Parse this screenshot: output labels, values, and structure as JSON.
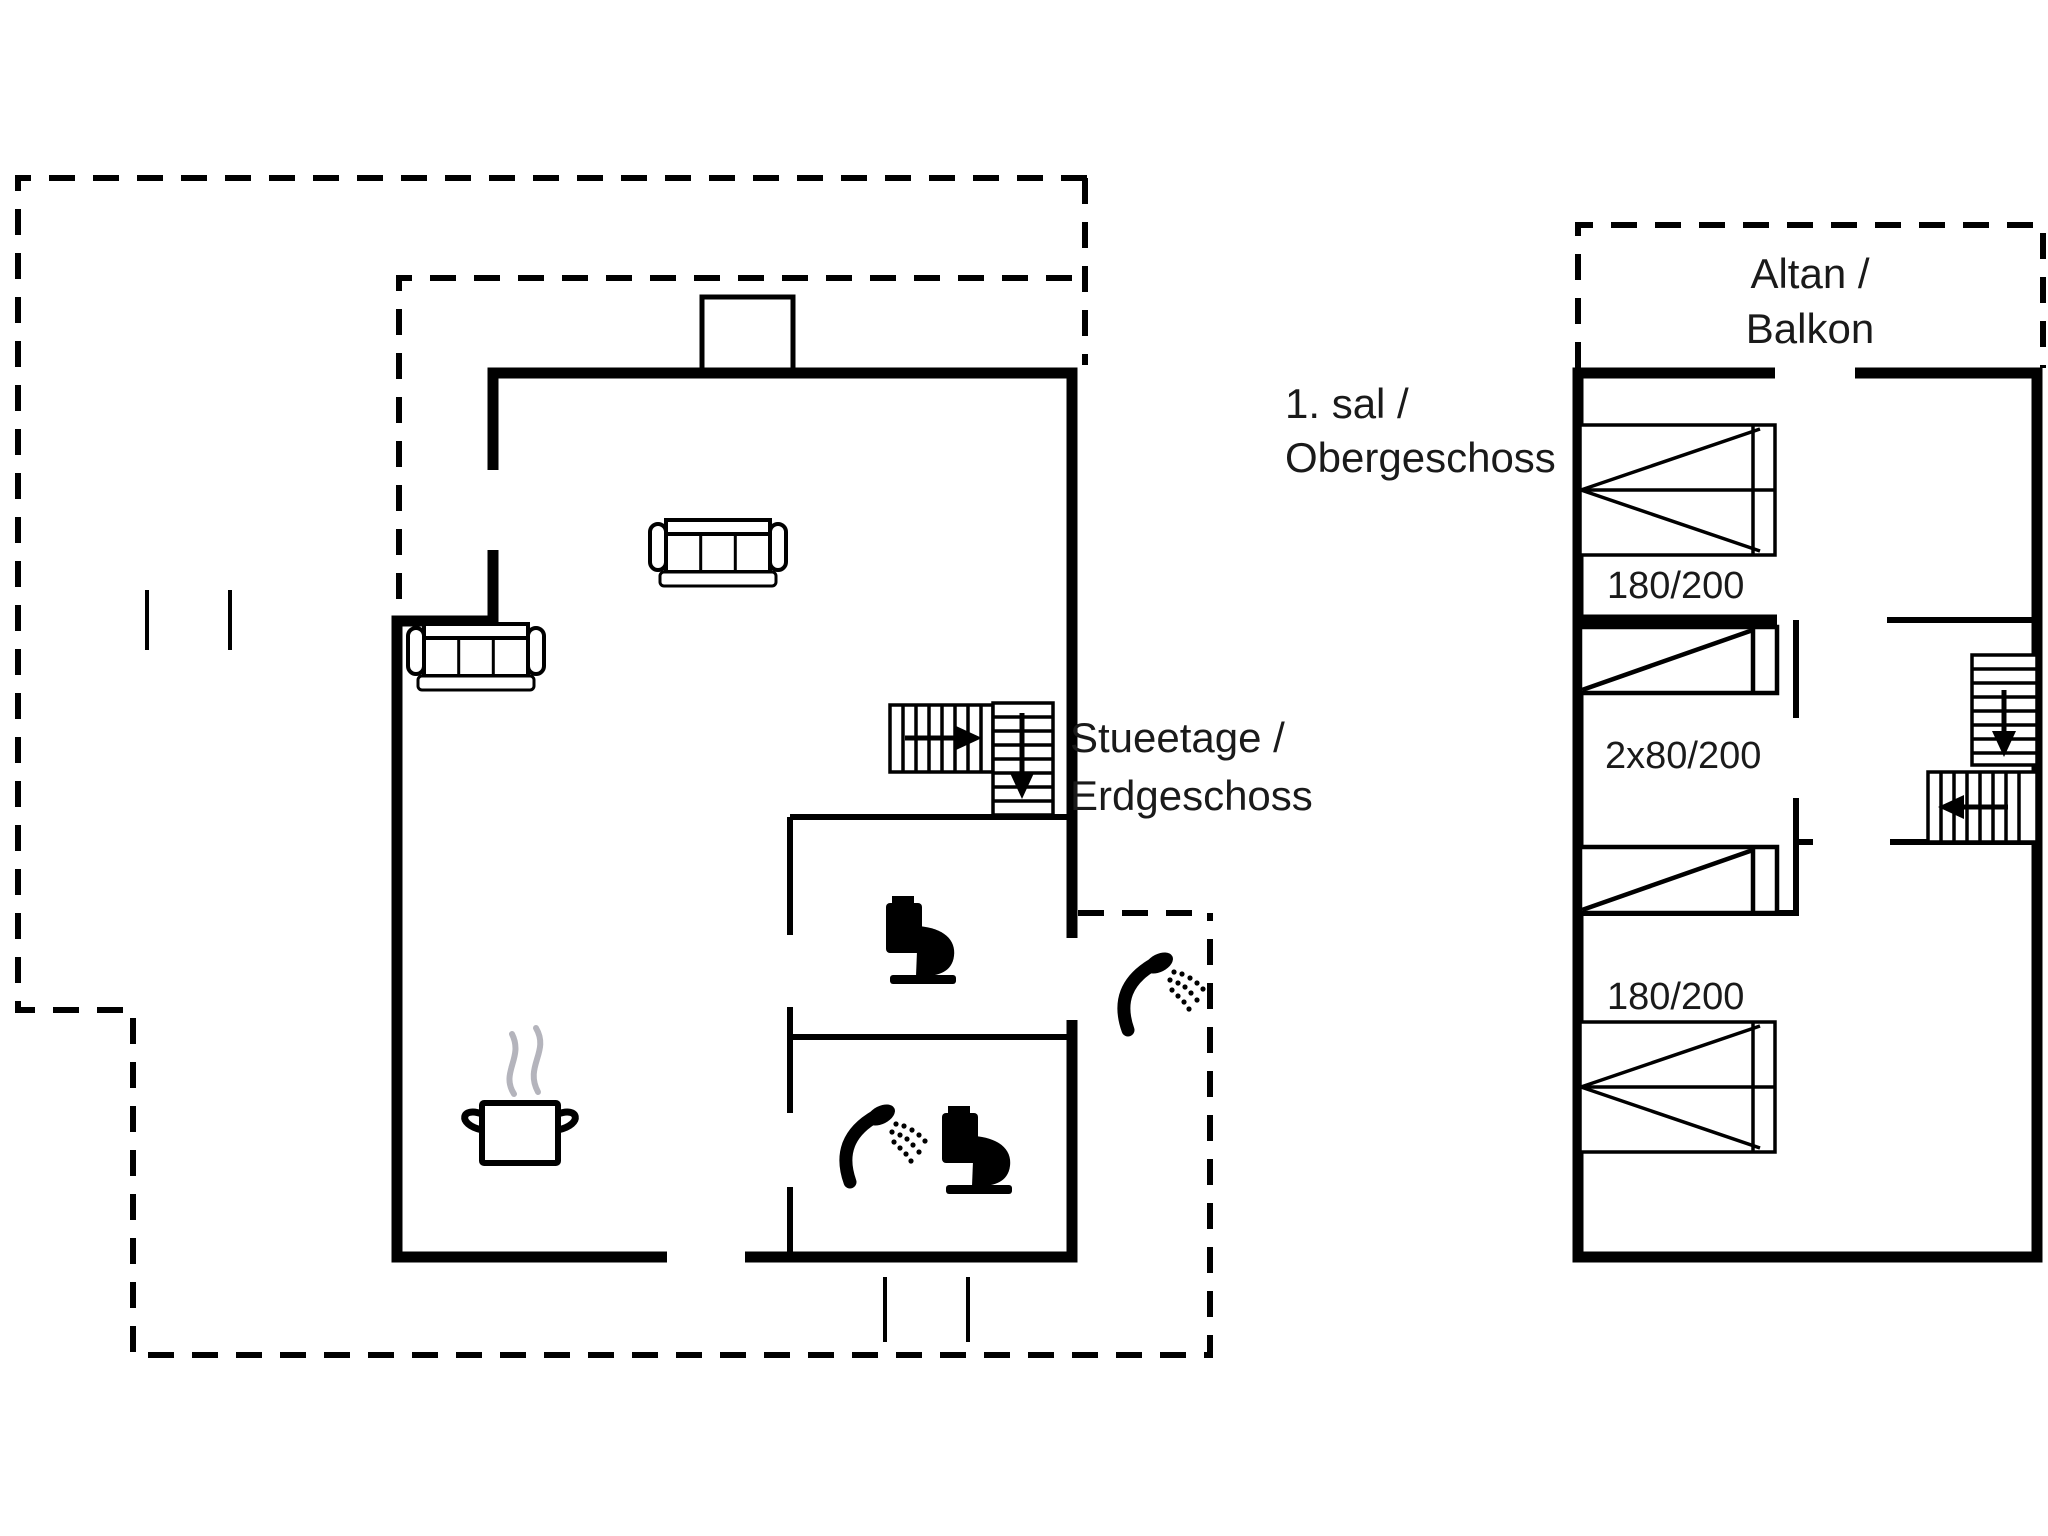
{
  "document": {
    "type": "house floor plan",
    "background_color": "#ffffff",
    "line_color": "#000000",
    "text_color": "#1a1a1a",
    "steam_color": "#b4b4bc"
  },
  "ground_floor": {
    "name_line1": "Stueetage /",
    "name_line2": "Erdgeschoss",
    "icons": [
      "sofa-icon",
      "sofa-icon",
      "cooking-pot-icon",
      "steam-icon",
      "toilet-icon",
      "toilet-icon",
      "shower-icon",
      "shower-icon",
      "stairs-up-icon",
      "chimney",
      "terrace-outline"
    ]
  },
  "upper_floor": {
    "name_line1": "1. sal /",
    "name_line2": "Obergeschoss",
    "balcony_line1": "Altan /",
    "balcony_line2": "Balkon",
    "beds": [
      {
        "type": "double",
        "size_label": "180/200"
      },
      {
        "type": "two-singles",
        "size_label": "2x80/200"
      },
      {
        "type": "double",
        "size_label": "180/200"
      }
    ],
    "icons": [
      "double-bed-icon",
      "single-bed-icon",
      "single-bed-icon",
      "double-bed-icon",
      "stairs-down-icon",
      "balcony-outline"
    ]
  }
}
